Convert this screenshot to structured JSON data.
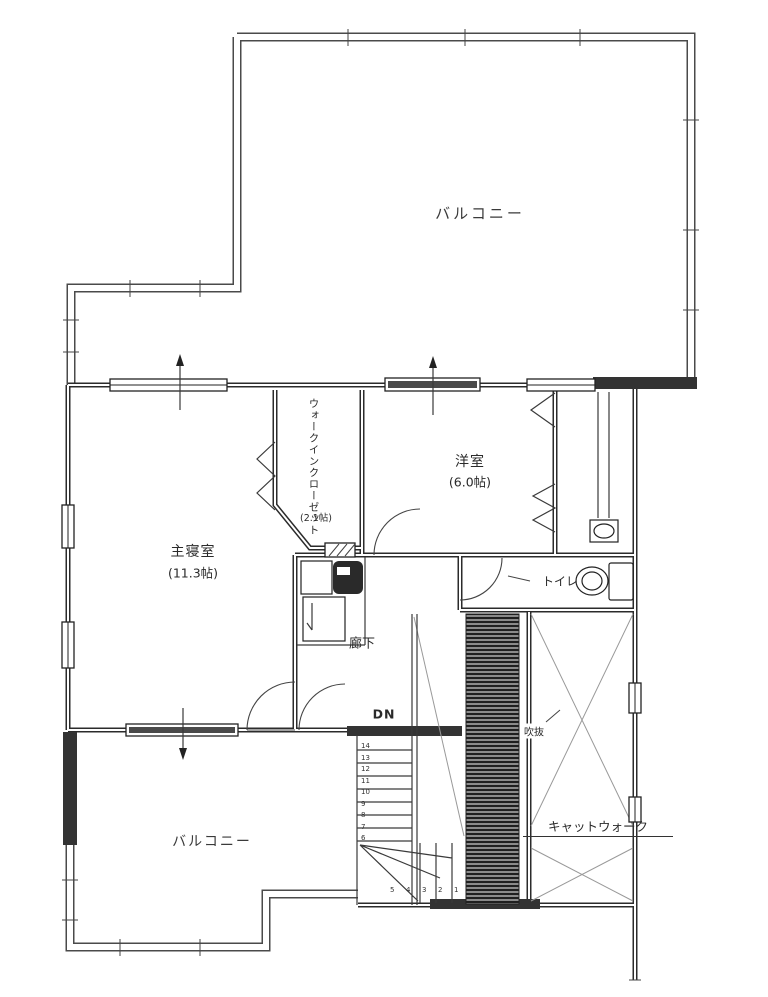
{
  "plan": {
    "labels": {
      "balcony_top": "バルコニー",
      "balcony_bottom": "バルコニー",
      "master_bedroom_name": "主寝室",
      "master_bedroom_size": "(11.3帖)",
      "western_room_name": "洋室",
      "western_room_size": "(6.0帖)",
      "wic_name": "ウォークインクローゼット",
      "wic_size": "(2.1帖)",
      "toilet": "トイレ",
      "hallway": "廊下",
      "stairs_dn": "DN",
      "void": "吹抜",
      "catwalk": "キャットウォーク"
    },
    "stairs": {
      "vertical_step_numbers": [
        "14",
        "13",
        "12",
        "11",
        "10",
        "9",
        "8",
        "7",
        "6"
      ],
      "bottom_step_numbers": [
        "5",
        "4",
        "3",
        "2",
        "1"
      ]
    },
    "colors": {
      "line": "#2b2b2b",
      "paper": "#ffffff",
      "solid_wall": "#333333",
      "hatch": "#8a8a8a"
    }
  }
}
